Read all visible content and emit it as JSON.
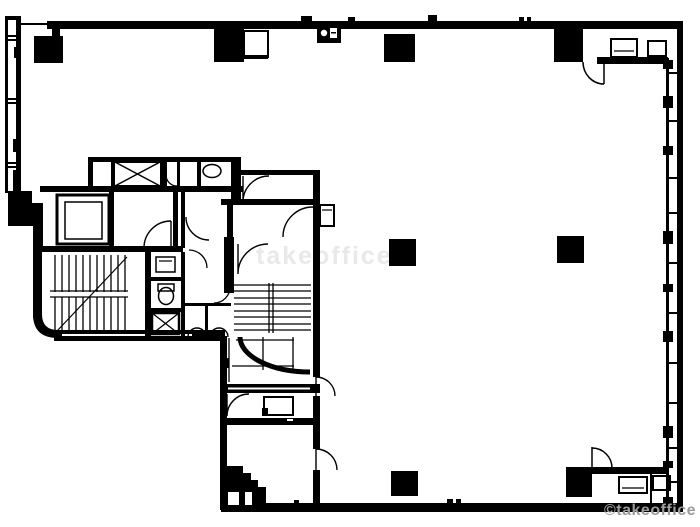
{
  "plan": {
    "title": "office-building-floor-plan",
    "watermark_bottom": "©takeoffice",
    "watermark_center": "takeoffice",
    "colors": {
      "ink": "#000000",
      "background": "#ffffff",
      "watermark_gray": "#9b9b9b",
      "watermark_faint": "#e9e9e9"
    }
  }
}
